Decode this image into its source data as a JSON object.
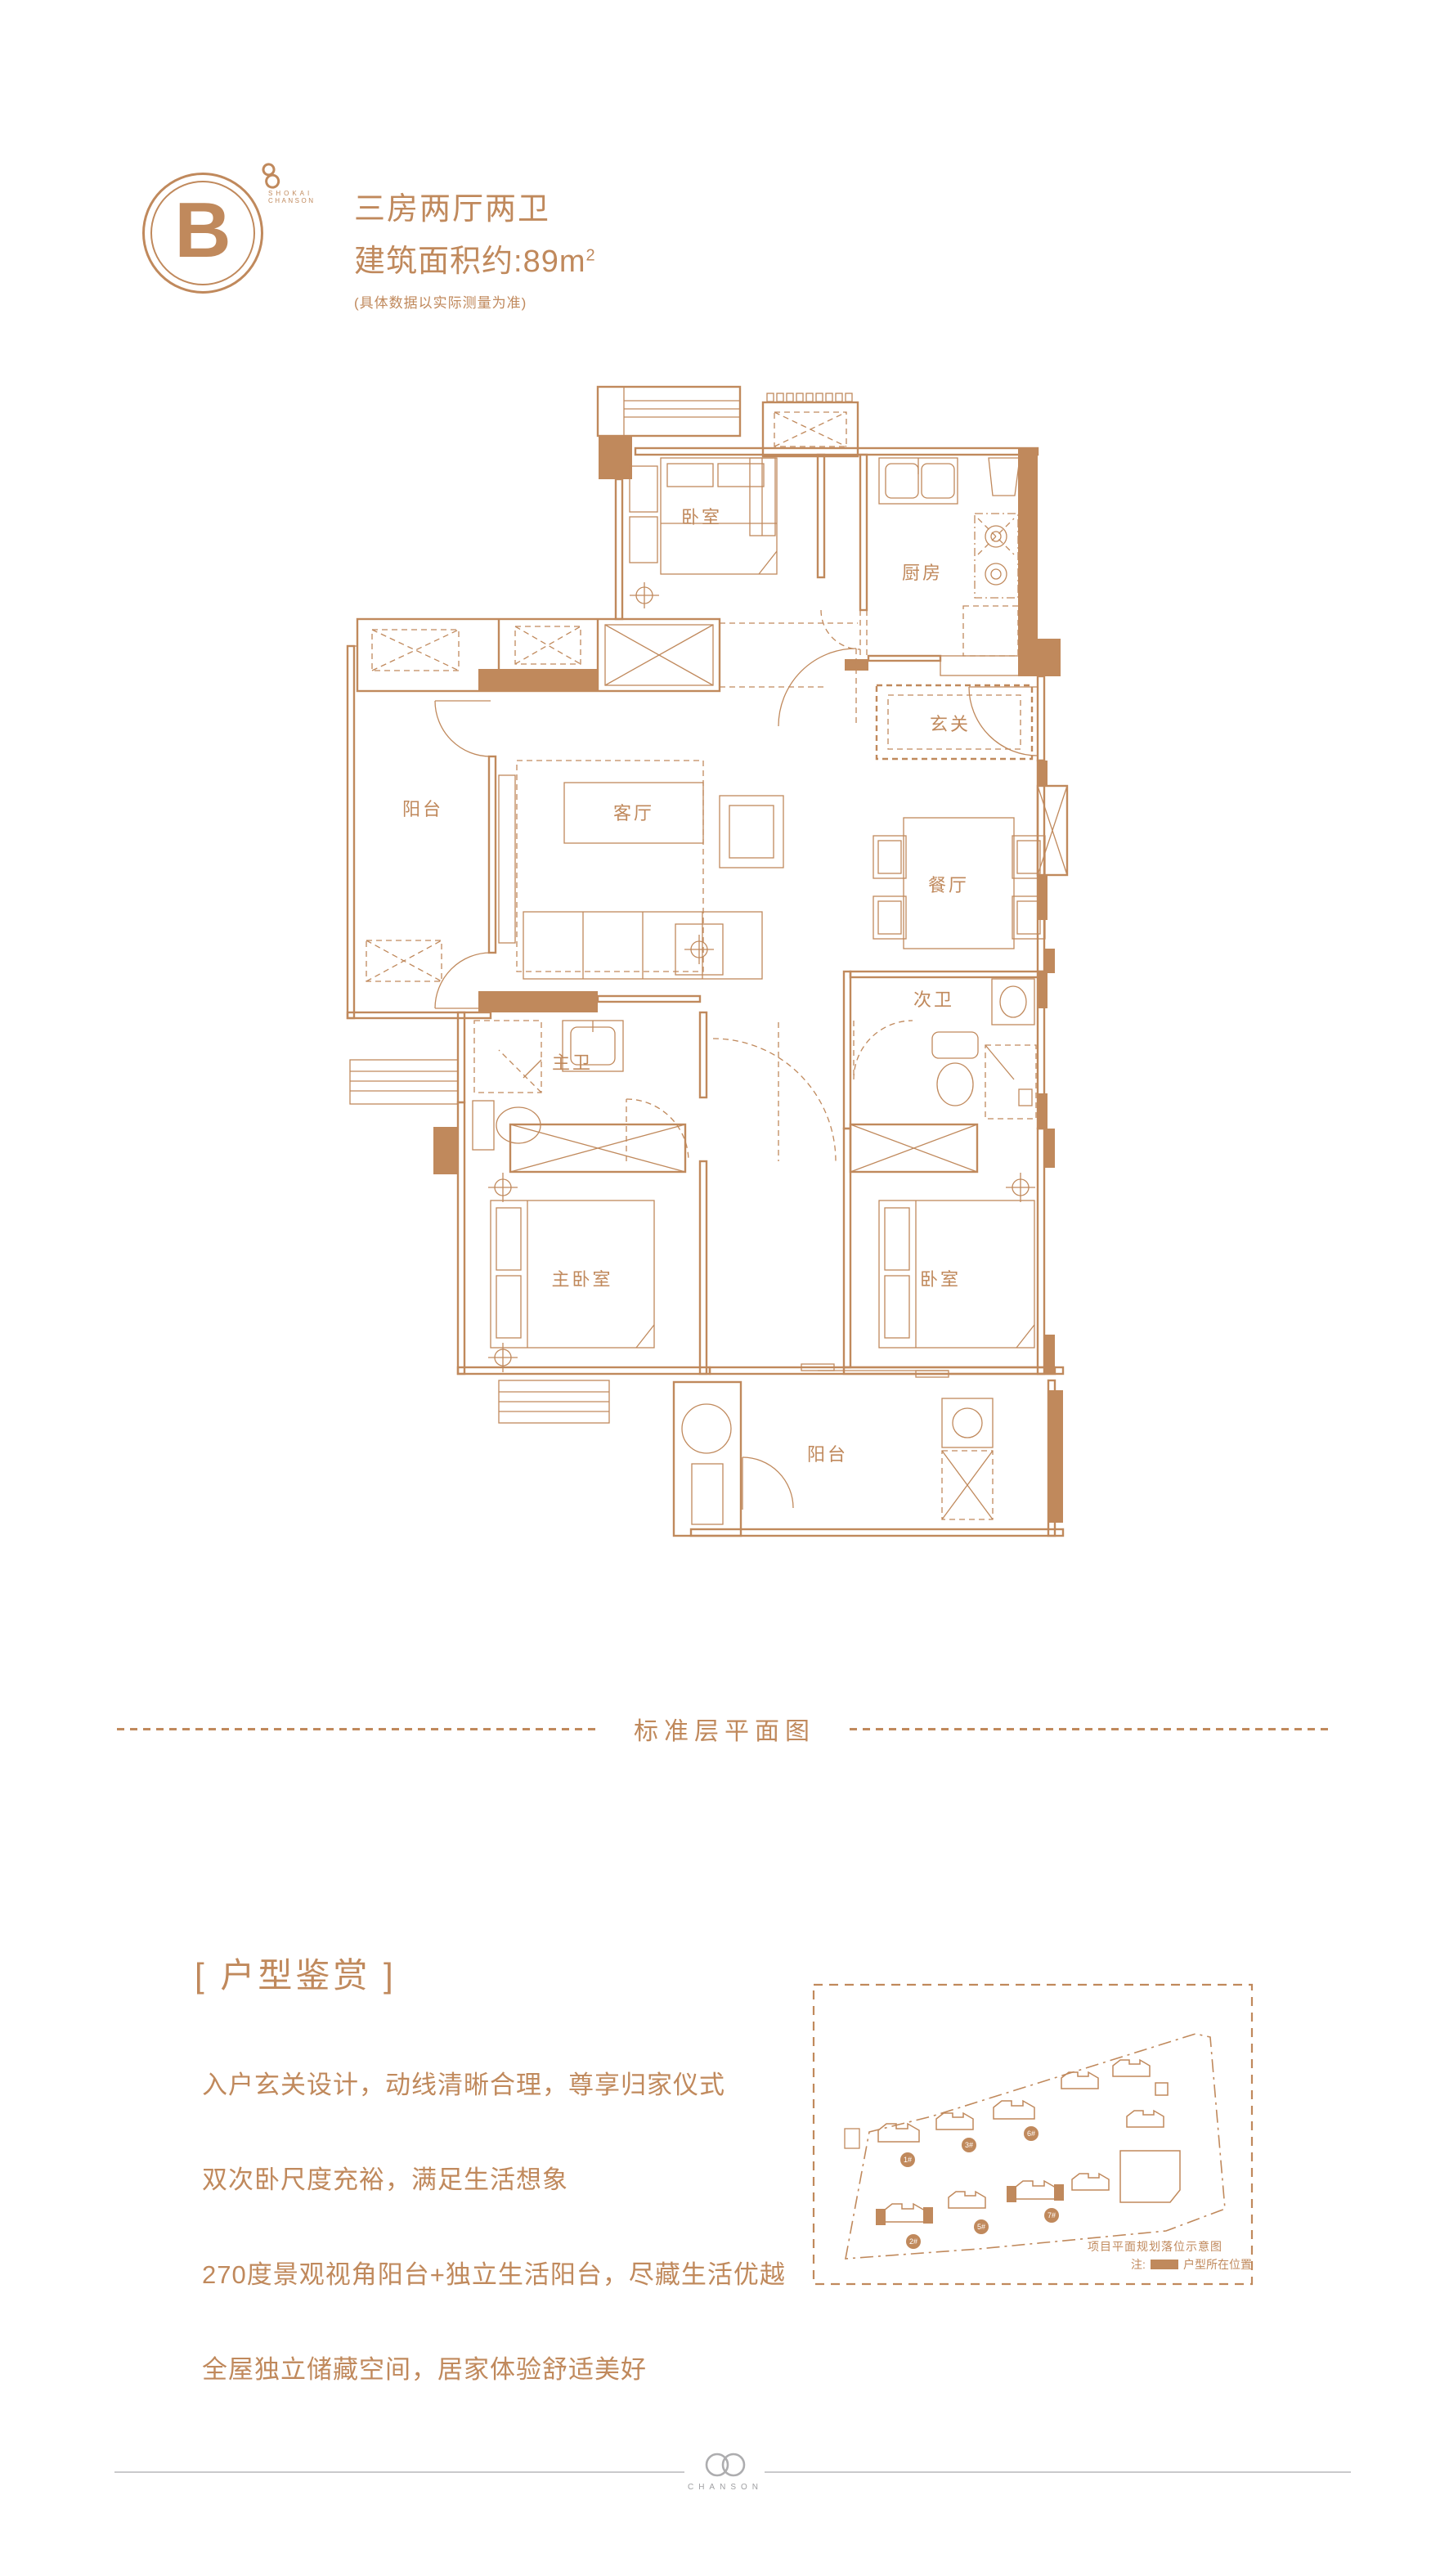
{
  "accent_color": "#C0895C",
  "badge": {
    "letter": "B",
    "brand_top": "SHOKAI",
    "brand_bottom": "CHANSON"
  },
  "header": {
    "title": "三房两厅两卫",
    "area_prefix": "建筑面积约:",
    "area_value": "89",
    "area_unit": "m",
    "area_sup": "2",
    "disclaimer": "(具体数据以实际测量为准)"
  },
  "floorplan": {
    "rooms": {
      "bedroom_top": "卧室",
      "kitchen": "厨房",
      "foyer": "玄关",
      "balcony_left": "阳台",
      "living": "客厅",
      "dining": "餐厅",
      "master_bath": "主卫",
      "second_bath": "次卫",
      "master_bedroom": "主卧室",
      "bedroom_right": "卧室",
      "balcony_bottom": "阳台"
    }
  },
  "divider": {
    "label": "标准层平面图"
  },
  "features": {
    "heading": "[ 户型鉴赏 ]",
    "items": [
      "入户玄关设计，动线清晰合理，尊享归家仪式",
      "双次卧尺度充裕，满足生活想象",
      "270度景观视角阳台+独立生活阳台，尽藏生活优越",
      "全屋独立储藏空间，居家体验舒适美好"
    ]
  },
  "siteplan": {
    "caption": "项目平面规划落位示意图",
    "legend_prefix": "注:",
    "legend_label": "户型所在位置",
    "buildings": [
      {
        "label": "1#"
      },
      {
        "label": "3#"
      },
      {
        "label": "6#"
      },
      {
        "label": "2#"
      },
      {
        "label": "5#"
      },
      {
        "label": "7#"
      }
    ]
  },
  "footer": {
    "brand": "CHANSON"
  }
}
